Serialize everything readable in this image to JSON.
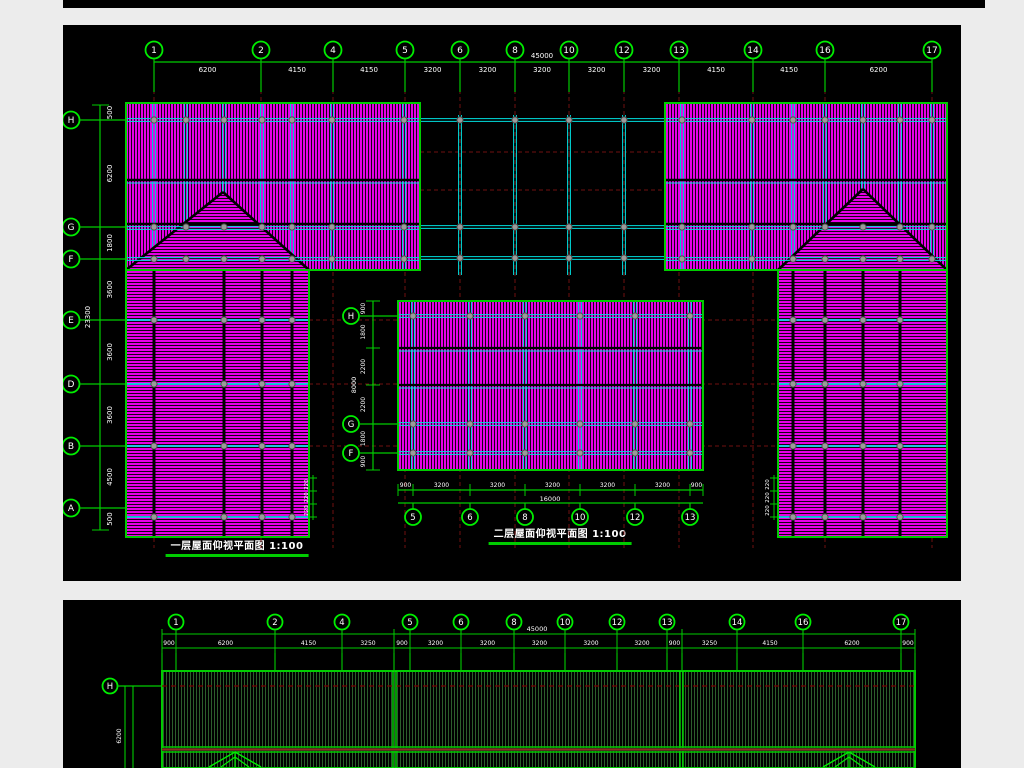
{
  "colors": {
    "page_bg": "#ececec",
    "panel_bg": "#000000",
    "green": "#00cc00",
    "bright_green": "#00ee00",
    "magenta": "#e600e6",
    "hatch_dark": "#150015",
    "cyan": "#00e0e0",
    "dark_red": "#701010",
    "node_fill": "#9a9a9a",
    "node_edge": "#4d4d4d",
    "white": "#ffffff",
    "elev_hatch": "#2b5e2b",
    "beam_fill": "#4a2a20",
    "beam_line": "#8b2e1e",
    "black": "#000000"
  },
  "plan1": {
    "title": "一层屋面仰视平面图",
    "scale_label": "1:100",
    "top_grid": {
      "bubbles": [
        "1",
        "2",
        "4",
        "5",
        "6",
        "8",
        "10",
        "12",
        "13",
        "14",
        "16",
        "17"
      ],
      "dims": [
        "6200",
        "4150",
        "4150",
        "3200",
        "3200",
        "3200",
        "3200",
        "3200",
        "4150",
        "4150",
        "6200"
      ],
      "overall": "45000"
    },
    "left_grid": {
      "bubbles": [
        "H",
        "G",
        "F",
        "E",
        "D",
        "B",
        "A"
      ],
      "dims": [
        "500",
        "6200",
        "1800",
        "3600",
        "3600",
        "3600",
        "4500",
        "500"
      ],
      "overall": "23300"
    },
    "edge_dims": [
      "220",
      "220",
      "220"
    ]
  },
  "plan2": {
    "title": "二层屋面仰视平面图",
    "scale_label": "1:100",
    "left_grid": {
      "bubbles": [
        "H",
        "G",
        "F"
      ],
      "dims": [
        "900",
        "1800",
        "2200",
        "2200",
        "1800",
        "900"
      ],
      "overall": "8000"
    },
    "bottom_grid": {
      "bubbles": [
        "5",
        "6",
        "8",
        "10",
        "12",
        "13"
      ],
      "dims": [
        "900",
        "3200",
        "3200",
        "3200",
        "3200",
        "3200",
        "900"
      ],
      "overall": "16000"
    }
  },
  "elevation": {
    "top_grid": {
      "bubbles": [
        "1",
        "2",
        "4",
        "5",
        "6",
        "8",
        "10",
        "12",
        "13",
        "14",
        "16",
        "17"
      ],
      "dims": [
        "900",
        "6200",
        "4150",
        "3250",
        "900",
        "3200",
        "3200",
        "3200",
        "3200",
        "3200",
        "900",
        "3250",
        "4150",
        "6200",
        "900"
      ],
      "overall": "45000"
    },
    "left_grid": {
      "bubbles": [
        "H"
      ],
      "dims": [
        "6200"
      ]
    }
  }
}
